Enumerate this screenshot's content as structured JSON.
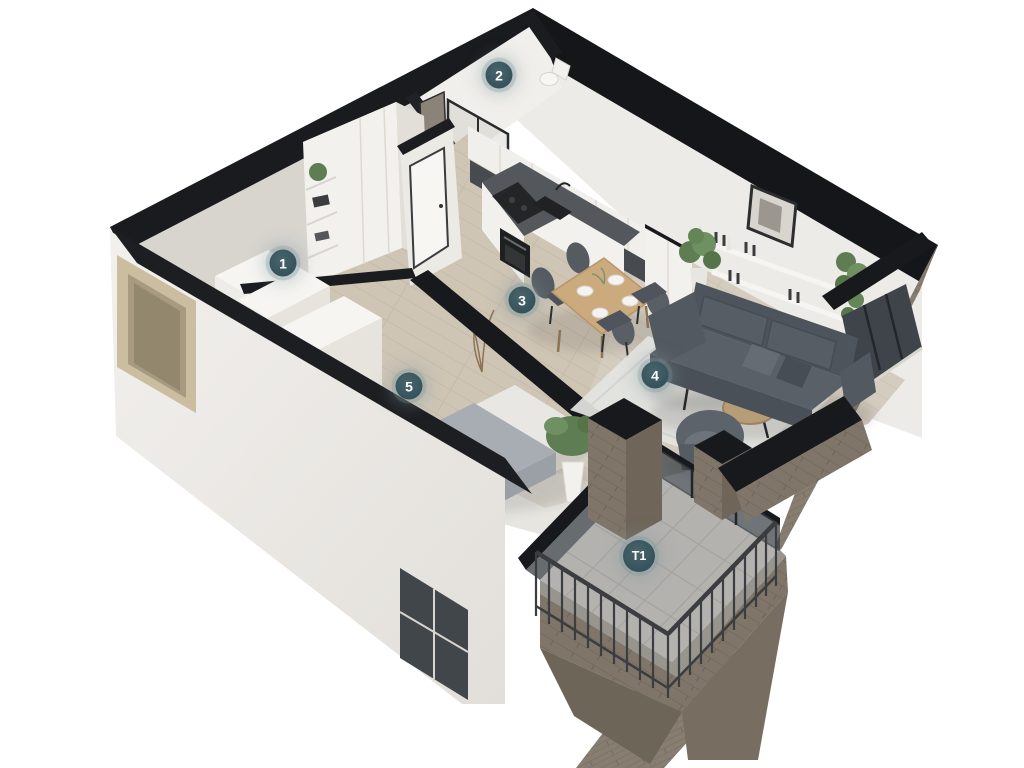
{
  "render": {
    "background_color": "#ffffff",
    "badge_color": "#3a565f",
    "badge_halo_color": "#7c969c",
    "badge_text_color": "#ffffff",
    "wall_cut_color": "#17191c",
    "wall_color": "#eae7e2",
    "wall_shadow_color": "#d6d3cd",
    "floor_wood_color": "#cfc5b5",
    "terrace_tile_color": "#b4b2af",
    "brick_color": "#877d70",
    "sofa_color": "#545a61",
    "chair_color": "#565b62",
    "table_wood_color": "#cbaa7e",
    "rug_color": "#e3e3e0",
    "plant_color": "#5e7d52"
  },
  "badges": [
    {
      "label": "1",
      "x": 283,
      "y": 263
    },
    {
      "label": "2",
      "x": 499,
      "y": 75
    },
    {
      "label": "3",
      "x": 522,
      "y": 300
    },
    {
      "label": "4",
      "x": 655,
      "y": 375
    },
    {
      "label": "5",
      "x": 409,
      "y": 386
    },
    {
      "label": "T1",
      "x": 639,
      "y": 556
    }
  ]
}
